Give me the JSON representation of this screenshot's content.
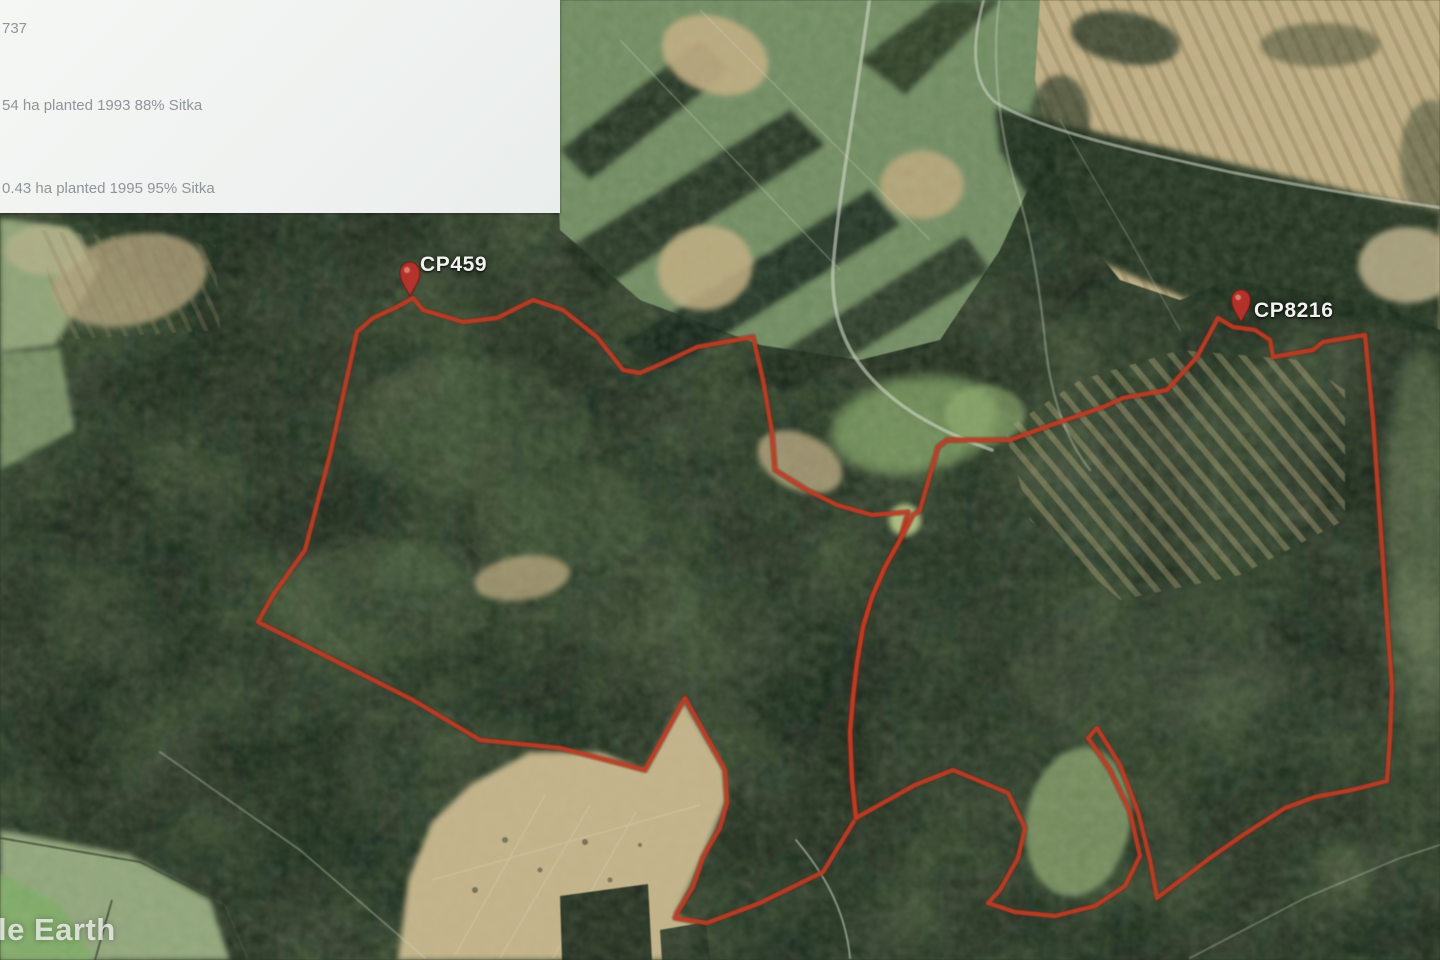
{
  "map": {
    "watermark": "le Earth",
    "placemarks": [
      {
        "label": "CP459"
      },
      {
        "label": "CP8216"
      }
    ]
  },
  "info_panel": {
    "lines": [
      "737",
      "54 ha planted 1993 88% Sitka",
      "0.43 ha planted 1995 95% Sitka"
    ]
  },
  "colors": {
    "boundary_red": "#c93a20",
    "pin_red": "#c62f28",
    "panel_background": "#f2f4f2",
    "panel_text": "#8f9598",
    "forest_green": "#243323",
    "field_green": "#7c9a6d",
    "bare_ground_tan": "#c6b284",
    "label_white": "#f3f3ef"
  }
}
